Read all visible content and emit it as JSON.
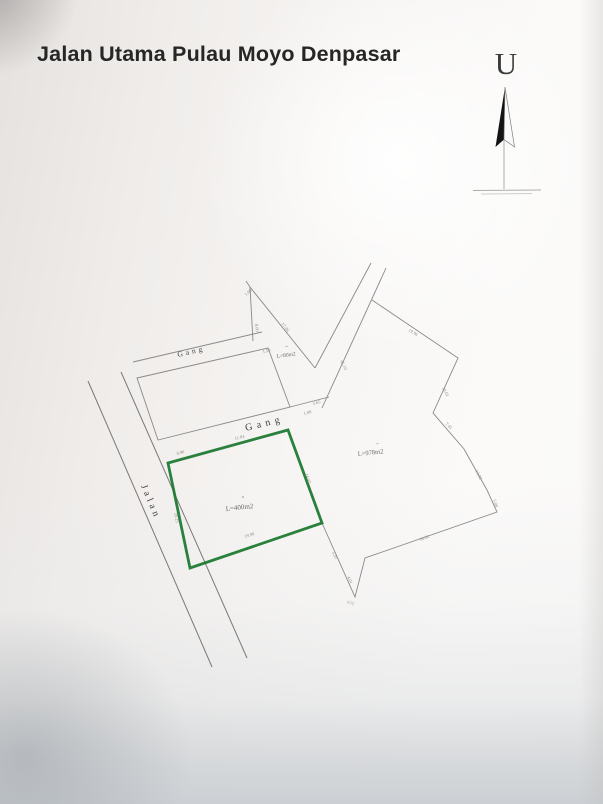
{
  "title": "Jalan Utama Pulau Moyo Denpasar",
  "compass": {
    "label": "U"
  },
  "plan": {
    "road_labels": {
      "jalan": "Jalan",
      "gang_upper": "Gang",
      "gang_lower": "Gang"
    },
    "plots": {
      "green": {
        "area": "L=400m2",
        "outline_color": "#1e7a33"
      },
      "large": {
        "area": "L=978m2"
      },
      "sliver": {
        "area": "L=80m2"
      }
    },
    "dims": [
      "1.00",
      "8.00",
      "17.46",
      "1.50",
      "45.10",
      "19.96",
      "10.01",
      "7.45",
      "13.02",
      "5.00",
      "16.52",
      "3.20",
      "4.01",
      "0.72",
      "3.65",
      "1.00",
      "11.04",
      "8.90",
      "14.02",
      "19.90",
      "20.25"
    ]
  }
}
